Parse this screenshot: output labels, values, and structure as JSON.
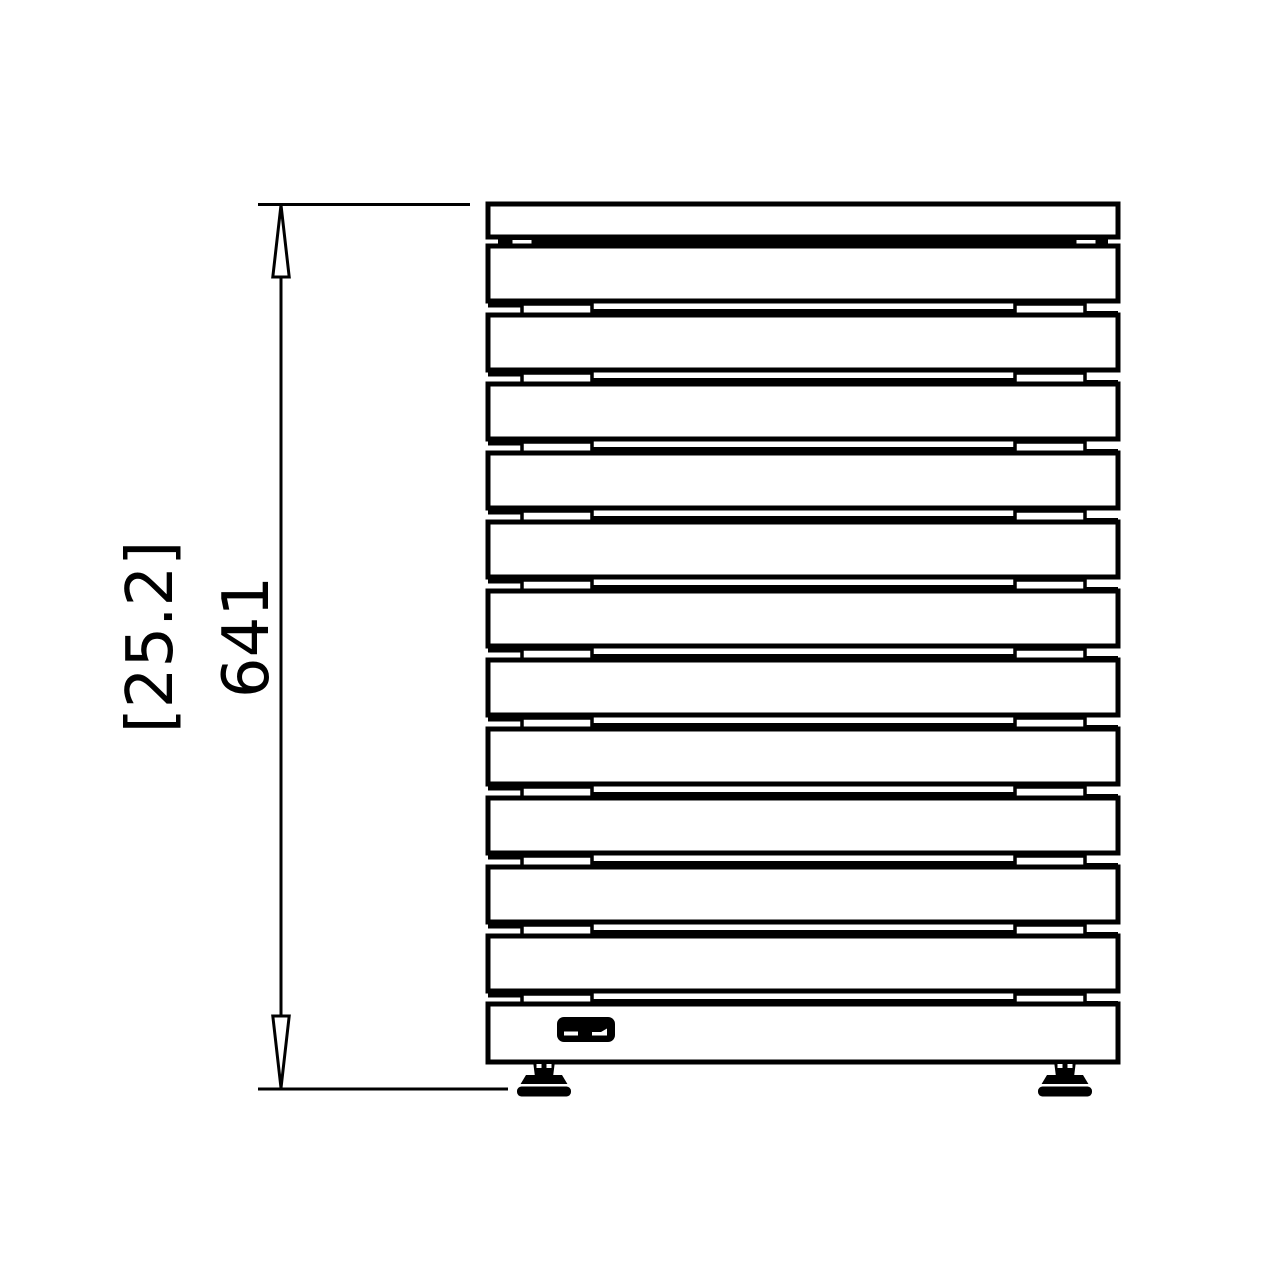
{
  "canvas": {
    "width": 1280,
    "height": 1280,
    "background": "#ffffff",
    "line_color": "#000000"
  },
  "dimension": {
    "imperial_label": "[25.2]",
    "metric_label": "641",
    "orientation": "vertical"
  },
  "diagram": {
    "type": "technical-elevation-drawing",
    "subject": "slatted panel heated towel radiator, front view",
    "slat_count": 11,
    "has_top_cap_slat": true,
    "has_base_panel": true,
    "has_brand_badge": true,
    "feet_count": 2
  },
  "geometry": {
    "dim": {
      "ext_top": {
        "x1": 258,
        "x2": 470,
        "y": 204.5
      },
      "ext_bottom": {
        "x1": 258,
        "x2": 508,
        "y": 1089
      },
      "line": {
        "x": 281,
        "y1": 205,
        "y2": 1088
      },
      "arrow": {
        "half_width": 8.2,
        "length": 72
      },
      "imperial_text": {
        "x": 150,
        "y": 637,
        "font_size": 64
      },
      "metric_text": {
        "x": 246,
        "y": 637,
        "font_size": 64
      }
    },
    "radiator": {
      "left": 488,
      "width": 630,
      "outline_stroke": 5,
      "thin_stroke": 4,
      "top_cap": {
        "top": 204,
        "height": 33
      },
      "top_gap": {
        "line_y": 241.5,
        "line_x1": 498,
        "line_x2": 1108,
        "tab_xs": [
          511,
          1075
        ],
        "tab_y": 238.5,
        "tab_w": 22,
        "tab_h": 6.5
      },
      "slats": {
        "count": 11,
        "first_top": 246,
        "pitch": 69,
        "height": 55
      },
      "gap_decor": {
        "left_stub_x2": 524,
        "left_tab_x": 522,
        "tab_w": 70,
        "tab_h": 10.5,
        "center_x1": 590,
        "center_x2": 1017,
        "right_tab_x": 1015,
        "right_stub_x1": 1083,
        "stub_dy": 4.5,
        "center_dy": 10,
        "right_stub_dy": 12,
        "tab_dy": 3
      },
      "base": {
        "top": 1004,
        "height": 58
      },
      "badge": {
        "x": 557,
        "y": 1017,
        "w": 58,
        "h": 25,
        "rx": 7,
        "mark1": {
          "x": 564,
          "y": 1031.5,
          "w": 14,
          "h": 4
        },
        "mark2_points": "592,1035.5 607,1035.5 607,1028.5 601,1032 592,1032"
      },
      "feet_center_x": [
        544,
        1065
      ],
      "foot": {
        "stem_top_y": 1061,
        "stem_bot_y": 1077,
        "stem_half_top": 11,
        "stem_half_bot": 9,
        "trap_top_y": 1075,
        "trap_bot_y": 1085,
        "trap_half_top": 18,
        "trap_half_bot": 24,
        "sep_y": 1084,
        "sep_half": 25,
        "sep_h": 2.5,
        "pad_y": 1086.5,
        "pad_half": 27,
        "pad_h": 10,
        "pad_rx": 4.5
      }
    }
  }
}
